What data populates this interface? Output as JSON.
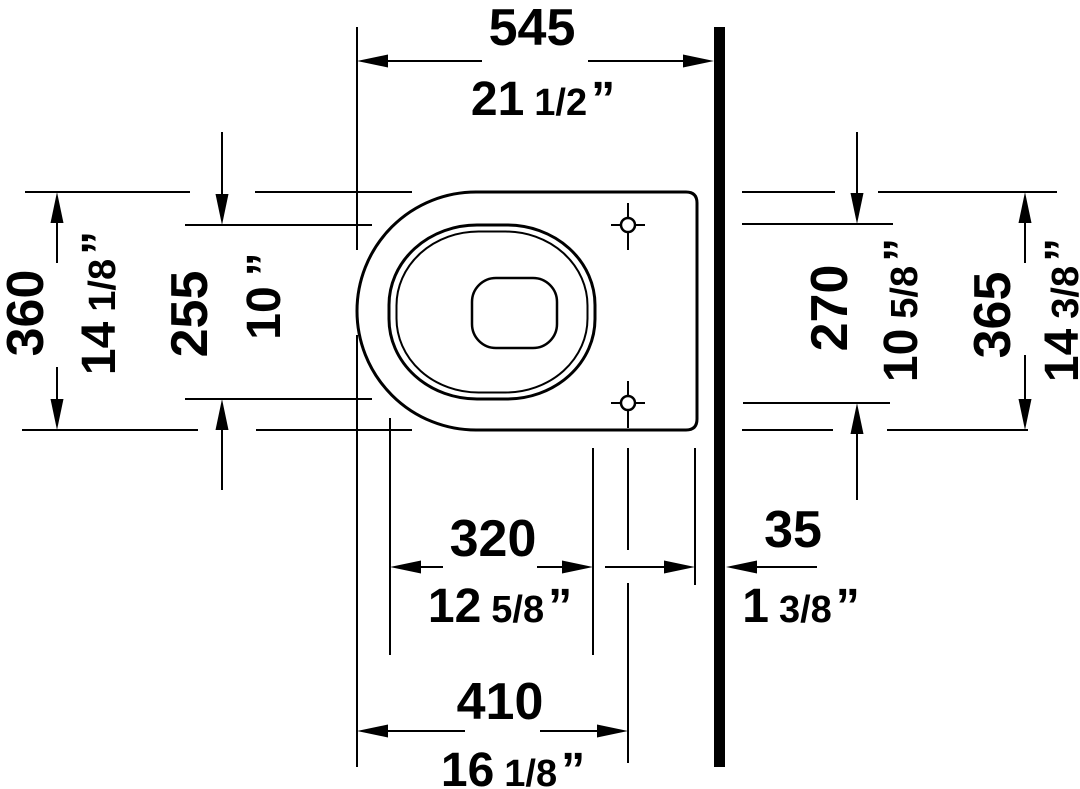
{
  "drawing": {
    "background": "#ffffff",
    "line_color": "#000000",
    "dims": {
      "overall_depth": {
        "mm": "545",
        "inch_int": "21",
        "inch_frac": "1/2",
        "inch_mark": "”"
      },
      "front_width": {
        "mm": "360",
        "inch_int": "14",
        "inch_frac": "1/8",
        "inch_mark": "”"
      },
      "bowl_opening_width": {
        "mm": "255",
        "inch_int": "10",
        "inch_frac": "",
        "inch_mark": "”"
      },
      "bolt_hole_spacing": {
        "mm": "270",
        "inch_int": "10",
        "inch_frac": "5/8",
        "inch_mark": "”"
      },
      "rear_width": {
        "mm": "365",
        "inch_int": "14",
        "inch_frac": "3/8",
        "inch_mark": "”"
      },
      "bowl_opening_depth": {
        "mm": "320",
        "inch_int": "12",
        "inch_frac": "5/8",
        "inch_mark": "”"
      },
      "wall_clearance": {
        "mm": "35",
        "inch_int": "1",
        "inch_frac": "3/8",
        "inch_mark": "”"
      },
      "front_to_bolt_depth": {
        "mm": "410",
        "inch_int": "16",
        "inch_frac": "1/8",
        "inch_mark": "”"
      }
    }
  }
}
